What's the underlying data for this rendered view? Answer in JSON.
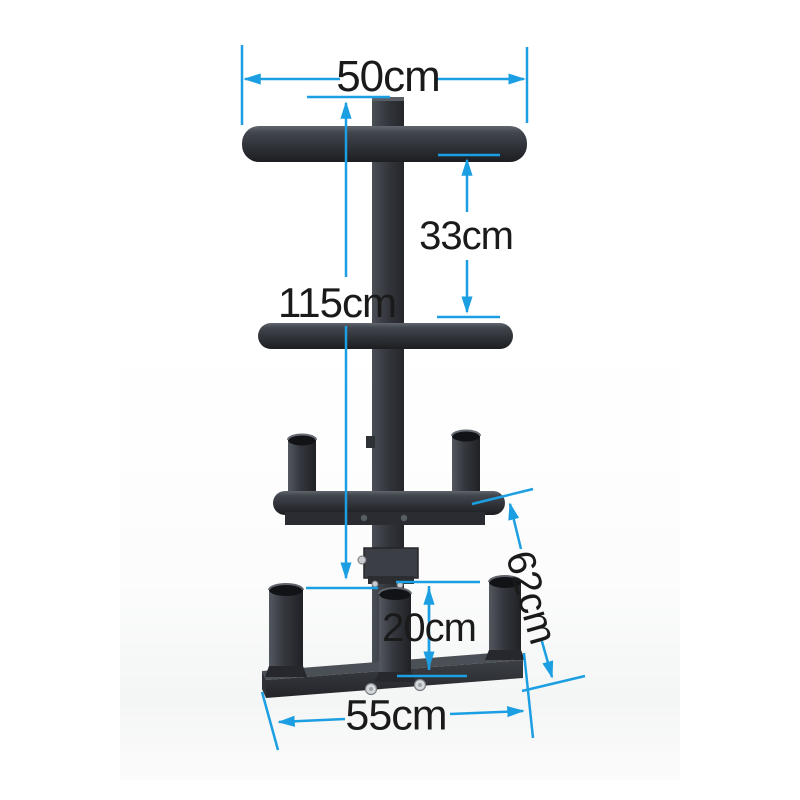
{
  "page": {
    "background_color": "#ffffff",
    "kind": "product dimension photo of a weight plate / barbell storage tree"
  },
  "colors": {
    "dimension_line_blue": "#1b9fe2",
    "label_text": "#1a1a1a",
    "steel_frame_dark": "#34373d",
    "bolt_metal": "#d6d9dc"
  },
  "annotations": {
    "top_bar_width": "50cm",
    "tier_gap": "33cm",
    "rack_height": "115cm",
    "holder_depth": "62cm",
    "base_post_height": "20cm",
    "base_width": "55cm"
  }
}
